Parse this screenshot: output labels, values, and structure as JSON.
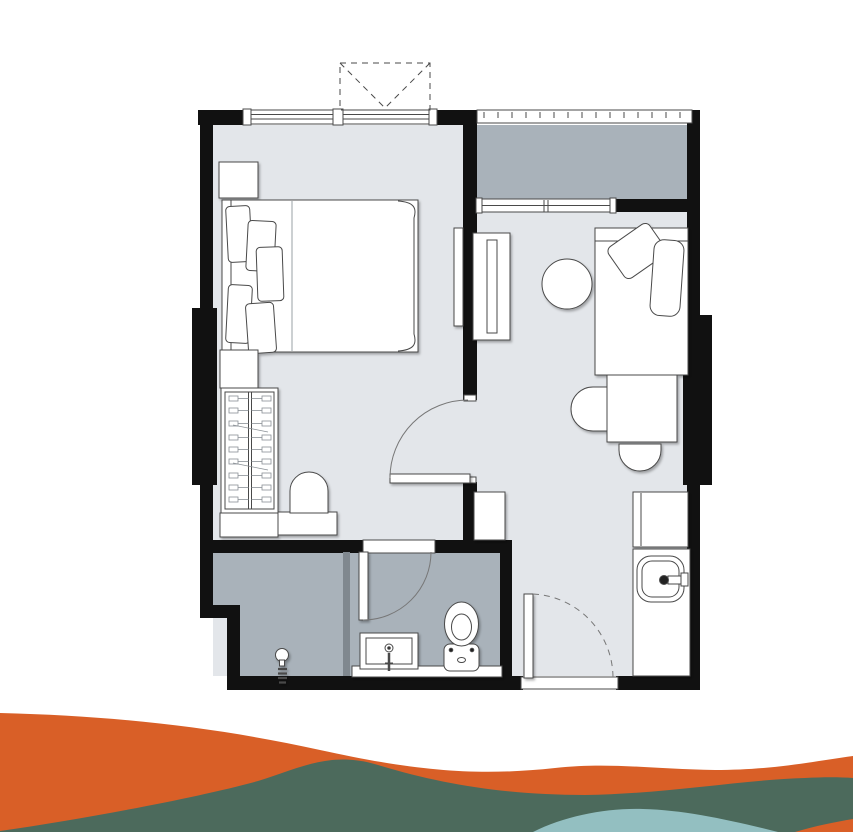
{
  "title": "one-bedroom-unit-floor-plan",
  "colors": {
    "background": "#ffffff",
    "wall": "#111111",
    "floor_light": "#e3e6ea",
    "floor_dark": "#a9b2ba",
    "partition": "#80888f",
    "furniture_fill": "#ffffff",
    "line": "#4a4a4a",
    "wave_orange": "#d95f27",
    "wave_green": "#4c6a5c",
    "wave_teal": "#93bfc1"
  },
  "plan": {
    "rooms": [
      "bedroom",
      "living-room",
      "balcony",
      "bathroom",
      "kitchenette",
      "entrance-hall"
    ],
    "objects": [
      "double-bed",
      "pillows",
      "nightstand",
      "wardrobe-with-hangers",
      "vanity-chair",
      "wall-tv",
      "tv-console",
      "round-table",
      "single-bed",
      "desk",
      "chairs",
      "fridge-cabinet",
      "kitchen-counter",
      "kitchen-sink",
      "hall-cabinet",
      "shower-head",
      "wash-basin",
      "toilet",
      "door-swings",
      "sliding-balcony-door",
      "window-with-casement-symbol",
      "balcony-railing"
    ]
  }
}
